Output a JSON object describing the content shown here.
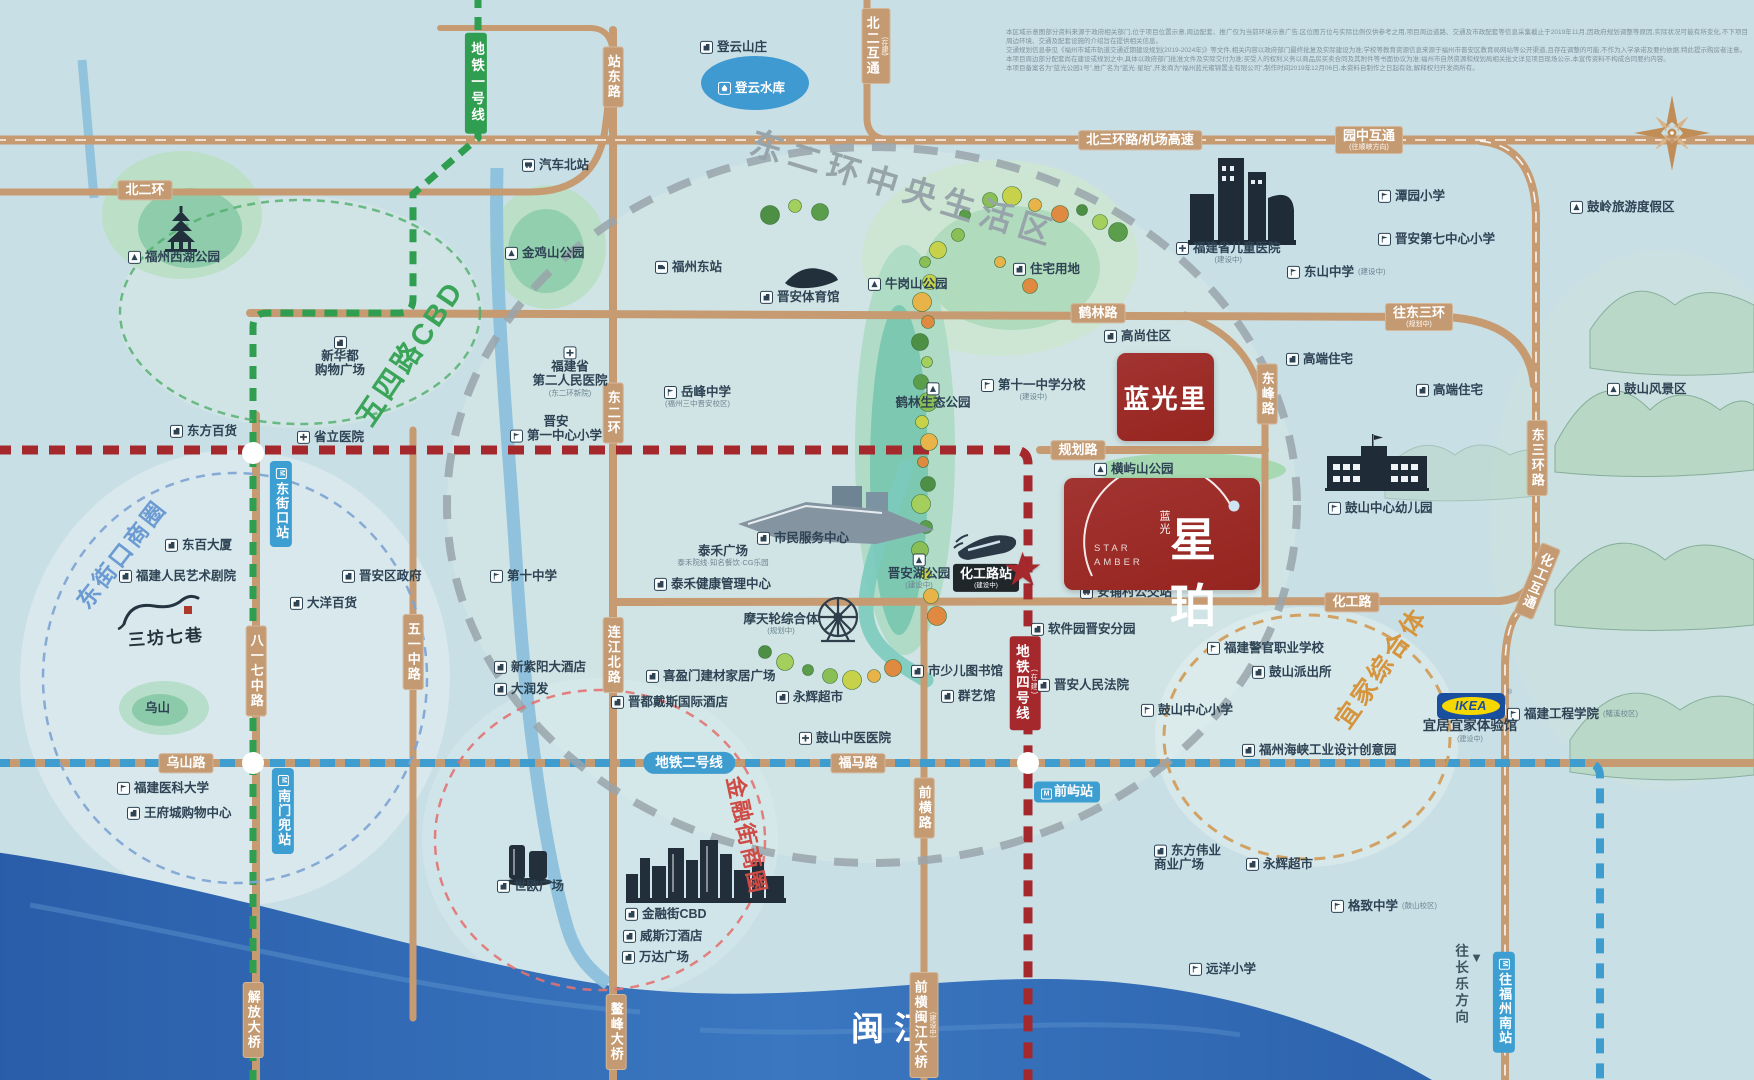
{
  "disclaimer": {
    "lines": [
      "本区域示意图部分资料来源于政府相关部门,位于项目位置示意,周边配套、推广仅为当前环境示意广告,区位图方位与实际比例仅供参考之用,项目周边道路、交通及市政配套等信息采集截止于2019年11月,因政府规划调整等原因,实际状况可能有所变化,不下项目周边环境、交通及配套设施的介绍旨在提供相关信息。",
      "交通规划信息参见《福州市城市轨道交通近期建设规划(2019-2024年)》等文件,相关内容以政府部门最终批复及实际建设为准;学校等教育资源信息来源于福州市晋安区教育局网站等公开渠道,且存在调整的可能,不作为入学承诺及要约依据,特此提示购房者注意。",
      "本项目周边部分配套尚在建设或规划之中,具体以政府部门批准文件及实际交付为准;买受人的权利义务以商品房买卖合同及其附件等书面协议为准;福州市自然资源和规划局相关批文详见项目现场公示,本宣传资料不构成合同要约内容。",
      "本项目备案名为“蓝光公园1号”,推广名为“蓝光·星珀”,开发商为“福州蓝光雍锦置业有限公司”,制作时间2019年12月06日,本资料自制作之日起有效,解释权归开发商所有。"
    ]
  },
  "brand": {
    "cn_small": "蓝光",
    "name": "星珀",
    "en1": "STAR",
    "en2": "AMBER",
    "sister_project": "蓝光里",
    "star": "★"
  },
  "ikea": {
    "logo": "IKEA",
    "reg": "®",
    "label": "宜居宜家体验馆",
    "sub": "(建设中)"
  },
  "water": {
    "minjiang": "闽江"
  },
  "landmarks": {
    "sanfang": "三坊七巷"
  },
  "direction": {
    "changle": "往长乐方向",
    "arrow": "▼"
  },
  "districts": [
    {
      "id": "dongerhuan-living-area",
      "label": "东二环中央生活区",
      "x": 905,
      "y": 186,
      "rot": 17,
      "size": 33,
      "ls": 7,
      "color": "#97a5ab"
    },
    {
      "id": "wusi-road-cbd",
      "label": "五四路CBD",
      "x": 408,
      "y": 352,
      "rot": -56,
      "size": 29,
      "ls": 3,
      "color": "#3aa558"
    },
    {
      "id": "dongjiekou-business-circle",
      "label": "东街口商圈",
      "x": 120,
      "y": 553,
      "rot": -52,
      "size": 23,
      "ls": 3,
      "color": "#6b9bd2"
    },
    {
      "id": "jinrongjie-business-circle",
      "label": "金融街商圈",
      "x": 748,
      "y": 835,
      "rot": 78,
      "size": 22,
      "ls": 2,
      "color": "#cf4b45"
    },
    {
      "id": "yijia-complex",
      "label": "宜家综合体",
      "x": 1380,
      "y": 667,
      "rot": -55,
      "size": 25,
      "ls": 3,
      "color": "#d6953c"
    }
  ],
  "metro_labels": [
    {
      "id": "line-1",
      "label": "地铁一号线",
      "cls": "m-green",
      "x": 476,
      "y": 83
    },
    {
      "id": "line-2",
      "label": "地铁二号线",
      "cls": "m-blue",
      "x": 689,
      "y": 763
    },
    {
      "id": "line-4",
      "label": "地铁四号线",
      "sub": "(在建)",
      "cls": "m-red",
      "x": 1025,
      "y": 683
    }
  ],
  "stations": [
    {
      "id": "dongjiekou",
      "label": "东街口站",
      "cls": "st-blue v",
      "x": 281,
      "y": 504
    },
    {
      "id": "nanmendou",
      "label": "南门兜站",
      "cls": "st-blue v",
      "x": 283,
      "y": 811
    },
    {
      "id": "qianyu",
      "label": "前屿站",
      "cls": "st-blue",
      "x": 1067,
      "y": 792
    },
    {
      "id": "huagonglu-station",
      "label": "化工路站",
      "sub": "(建设中)",
      "cls": "st-black",
      "x": 986,
      "y": 578
    },
    {
      "id": "to-fuzhou-south",
      "label": "往福州南站",
      "cls": "st-blue v",
      "x": 1504,
      "y": 1002
    }
  ],
  "road_labels": [
    {
      "id": "beisanhuan-airport",
      "label": "北三环路/机场高速",
      "x": 1140,
      "y": 140
    },
    {
      "id": "yuanzhong-interchange",
      "label": "园中互通",
      "sub": "(往顺峡方向)",
      "x": 1369,
      "y": 140
    },
    {
      "id": "beierhuan",
      "label": "北二环",
      "x": 145,
      "y": 190
    },
    {
      "id": "beier-interchange",
      "label": "北二互通",
      "sub": "(在建)",
      "v": true,
      "x": 876,
      "y": 46
    },
    {
      "id": "zhandong-road",
      "label": "站东路",
      "v": true,
      "x": 613,
      "y": 77
    },
    {
      "id": "helin-road",
      "label": "鹤林路",
      "x": 1098,
      "y": 313
    },
    {
      "id": "to-dongsanhuan",
      "label": "往东三环",
      "sub": "(规划中)",
      "x": 1419,
      "y": 317
    },
    {
      "id": "dongsanhuan-road",
      "label": "东三环路",
      "v": true,
      "x": 1537,
      "y": 458
    },
    {
      "id": "huagong-interchange",
      "label": "化工互通",
      "v": true,
      "rot": 22,
      "x": 1537,
      "y": 581
    },
    {
      "id": "huagong-road",
      "label": "化工路",
      "x": 1352,
      "y": 602
    },
    {
      "id": "guihua-road",
      "label": "规划路",
      "x": 1078,
      "y": 450
    },
    {
      "id": "dongfeng-road",
      "label": "东峰路",
      "v": true,
      "x": 1267,
      "y": 394
    },
    {
      "id": "dongerhuan-road",
      "label": "东二环",
      "v": true,
      "x": 613,
      "y": 413
    },
    {
      "id": "lianjiangbei-road",
      "label": "连江北路",
      "v": true,
      "x": 613,
      "y": 655
    },
    {
      "id": "wuyizhong-road",
      "label": "五一中路",
      "v": true,
      "x": 413,
      "y": 652
    },
    {
      "id": "bayiqizhong-road",
      "label": "八一七中路",
      "v": true,
      "x": 256,
      "y": 671
    },
    {
      "id": "wushan-road",
      "label": "乌山路",
      "x": 186,
      "y": 763
    },
    {
      "id": "fuma-road",
      "label": "福马路",
      "x": 858,
      "y": 763
    },
    {
      "id": "qianheng-road",
      "label": "前横路",
      "v": true,
      "x": 924,
      "y": 808
    },
    {
      "id": "jiefang-bridge",
      "label": "解放大桥",
      "v": true,
      "x": 253,
      "y": 1020
    },
    {
      "id": "aofeng-bridge",
      "label": "鳌峰大桥",
      "v": true,
      "x": 616,
      "y": 1032
    },
    {
      "id": "qianheng-minjiang-bridge",
      "label": "前横闽江大桥",
      "sub": "(建设中)",
      "v": true,
      "x": 924,
      "y": 1025
    }
  ],
  "pois": [
    {
      "id": "dengyun-villa",
      "icon": "building",
      "label": "登云山庄",
      "x": 700,
      "y": 47
    },
    {
      "id": "dengyun-reservoir",
      "icon": "water",
      "label": "登云水库",
      "x": 718,
      "y": 88,
      "white": true
    },
    {
      "id": "qiche-beizhan",
      "icon": "bus",
      "label": "汽车北站",
      "x": 522,
      "y": 165
    },
    {
      "id": "fuzhou-east-station",
      "icon": "train",
      "label": "福州东站",
      "x": 655,
      "y": 267
    },
    {
      "id": "jinjishan-park",
      "icon": "mountain",
      "label": "金鸡山公园",
      "x": 505,
      "y": 253
    },
    {
      "id": "xihu-park",
      "icon": "mountain",
      "label": "福州西湖公园",
      "x": 128,
      "y": 257
    },
    {
      "id": "jinan-stadium",
      "icon": "building",
      "label": "晋安体育馆",
      "x": 760,
      "y": 297
    },
    {
      "id": "niugangshan-park",
      "icon": "mountain",
      "label": "牛岗山公园",
      "x": 868,
      "y": 284
    },
    {
      "id": "zhuzhai-land",
      "icon": "building",
      "label": "住宅用地",
      "x": 1013,
      "y": 269
    },
    {
      "id": "children-hospital",
      "icon": "hospital",
      "label": "福建省儿童医院",
      "sub": "(建设中)",
      "subpos": "below",
      "x": 1176,
      "y": 253
    },
    {
      "id": "tanyuan-primary",
      "icon": "school",
      "label": "潭园小学",
      "x": 1378,
      "y": 196
    },
    {
      "id": "jinan-no7-primary",
      "icon": "school",
      "label": "晋安第七中心小学",
      "x": 1378,
      "y": 239
    },
    {
      "id": "dongshan-middle",
      "icon": "school",
      "label": "东山中学",
      "sub": "(建设中)",
      "x": 1287,
      "y": 272
    },
    {
      "id": "gaoshang-zhuqu",
      "icon": "building",
      "label": "高尚住区",
      "x": 1104,
      "y": 336
    },
    {
      "id": "gaoduan-zhuzhai-1",
      "icon": "building",
      "label": "高端住宅",
      "x": 1286,
      "y": 359
    },
    {
      "id": "gaoduan-zhuzhai-2",
      "icon": "building",
      "label": "高端住宅",
      "x": 1416,
      "y": 390
    },
    {
      "id": "no11-middle-branch",
      "icon": "school",
      "label": "第十一中学分校",
      "sub": "(建设中)",
      "subpos": "below",
      "x": 981,
      "y": 390
    },
    {
      "id": "hengyushan-park",
      "icon": "mountain",
      "label": "横屿山公园",
      "x": 1094,
      "y": 469
    },
    {
      "id": "guling-resort",
      "icon": "mountain",
      "label": "鼓岭旅游度假区",
      "x": 1570,
      "y": 207
    },
    {
      "id": "gushan-scenic",
      "icon": "mountain",
      "label": "鼓山风景区",
      "x": 1607,
      "y": 389
    },
    {
      "id": "gushan-kindergarten",
      "icon": "school",
      "label": "鼓山中心幼儿园",
      "x": 1328,
      "y": 508
    },
    {
      "id": "helin-eco-park",
      "icon": "mountain",
      "label": "鹤林生态公园",
      "x": 933,
      "y": 396,
      "center": true,
      "icontop": true
    },
    {
      "id": "yuefeng-middle",
      "icon": "school",
      "label": "岳峰中学",
      "sub": "(福州三中晋安校区)",
      "subpos": "below",
      "x": 664,
      "y": 397
    },
    {
      "id": "prov-2nd-hospital",
      "icon": "hospital",
      "lines": [
        "福建省",
        "第二人民医院"
      ],
      "sub": "(东二环新院)",
      "subpos": "below",
      "center": true,
      "icontop": true,
      "x": 570,
      "y": 372
    },
    {
      "id": "jinan-no1-primary",
      "icon": "school",
      "lines": [
        "晋安",
        "第一中心小学"
      ],
      "iconline": 1,
      "center": true,
      "x": 556,
      "y": 429
    },
    {
      "id": "xinhuadu-mall",
      "icon": "building",
      "lines": [
        "新华都",
        "购物广场"
      ],
      "center": true,
      "icontop": true,
      "x": 340,
      "y": 357
    },
    {
      "id": "no10-middle",
      "icon": "school",
      "label": "第十中学",
      "x": 490,
      "y": 576
    },
    {
      "id": "jinan-district-govt",
      "icon": "building",
      "label": "晋安区政府",
      "x": 342,
      "y": 576
    },
    {
      "id": "dongfang-dept-store",
      "icon": "building",
      "label": "东方百货",
      "x": 170,
      "y": 431
    },
    {
      "id": "provincial-hospital",
      "icon": "hospital",
      "label": "省立医院",
      "x": 297,
      "y": 437
    },
    {
      "id": "dongbai-building",
      "icon": "building",
      "label": "东百大厦",
      "x": 165,
      "y": 545
    },
    {
      "id": "renmin-art-theatre",
      "icon": "building",
      "label": "福建人民艺术剧院",
      "x": 119,
      "y": 576
    },
    {
      "id": "dayang-dept-store",
      "icon": "building",
      "label": "大洋百货",
      "x": 290,
      "y": 603
    },
    {
      "id": "wushan-hill",
      "label": "乌山",
      "noicon": true,
      "x": 145,
      "y": 708
    },
    {
      "id": "fujian-medical-univ",
      "icon": "school",
      "label": "福建医科大学",
      "x": 117,
      "y": 788
    },
    {
      "id": "wangfucheng-mall",
      "icon": "building",
      "label": "王府城购物中心",
      "x": 127,
      "y": 813
    },
    {
      "id": "xinziyang-hotel",
      "icon": "building",
      "label": "新紫阳大酒店",
      "x": 494,
      "y": 667
    },
    {
      "id": "darunfa",
      "icon": "building",
      "label": "大润发",
      "x": 494,
      "y": 689
    },
    {
      "id": "xiyingmen-plaza",
      "icon": "building",
      "label": "喜盈门建材家居广场",
      "x": 646,
      "y": 676
    },
    {
      "id": "jindu-days-hotel",
      "icon": "building",
      "label": "晋都戴斯国际酒店",
      "x": 611,
      "y": 702
    },
    {
      "id": "yonghui-market-1",
      "icon": "building",
      "label": "永辉超市",
      "x": 776,
      "y": 697
    },
    {
      "id": "gushan-tcm-hospital",
      "icon": "hospital",
      "label": "鼓山中医医院",
      "x": 799,
      "y": 738
    },
    {
      "id": "citizen-service-center",
      "icon": "building",
      "label": "市民服务中心",
      "x": 757,
      "y": 538
    },
    {
      "id": "taihe-plaza",
      "label": "泰禾广场",
      "sub": "泰禾院线·知名餐饮·CG乐园",
      "subpos": "below",
      "center": true,
      "noicon": true,
      "x": 723,
      "y": 556
    },
    {
      "id": "taihe-health-center",
      "icon": "building",
      "label": "泰禾健康管理中心",
      "x": 654,
      "y": 584
    },
    {
      "id": "ferris-wheel-complex",
      "label": "摩天轮综合体",
      "sub": "(规划中)",
      "subpos": "below",
      "center": true,
      "noicon": true,
      "x": 781,
      "y": 624
    },
    {
      "id": "jinanhu-park",
      "icon": "mountain",
      "label": "晋安湖公园",
      "sub": "(建设中)",
      "subpos": "below",
      "center": true,
      "icontop": true,
      "x": 919,
      "y": 572
    },
    {
      "id": "children-library",
      "icon": "building",
      "label": "市少儿图书馆",
      "x": 911,
      "y": 671
    },
    {
      "id": "qunyi-hall",
      "icon": "building",
      "label": "群艺馆",
      "x": 941,
      "y": 696
    },
    {
      "id": "jinan-court",
      "icon": "building",
      "label": "晋安人民法院",
      "x": 1037,
      "y": 685
    },
    {
      "id": "software-park-jinan",
      "icon": "building",
      "label": "软件园晋安分园",
      "x": 1031,
      "y": 629
    },
    {
      "id": "anpucun-bus-stop",
      "icon": "bus",
      "label": "安铺村公交站",
      "x": 1080,
      "y": 592
    },
    {
      "id": "police-vocational-school",
      "icon": "school",
      "label": "福建警官职业学校",
      "x": 1207,
      "y": 648
    },
    {
      "id": "gushan-police-station",
      "icon": "building",
      "label": "鼓山派出所",
      "x": 1252,
      "y": 672
    },
    {
      "id": "gushan-central-primary",
      "icon": "school",
      "label": "鼓山中心小学",
      "x": 1141,
      "y": 710
    },
    {
      "id": "haixia-design-park",
      "icon": "building",
      "label": "福州海峡工业设计创意园",
      "x": 1242,
      "y": 750
    },
    {
      "id": "fujian-univ-of-tech",
      "icon": "school",
      "label": "福建工程学院",
      "sub": "(鳝溪校区)",
      "x": 1507,
      "y": 714
    },
    {
      "id": "dongfang-weiye",
      "icon": "building",
      "lines": [
        "东方伟业",
        "商业广场"
      ],
      "iconline": 0,
      "x": 1154,
      "y": 858
    },
    {
      "id": "yonghui-market-2",
      "icon": "building",
      "label": "永辉超市",
      "x": 1246,
      "y": 864
    },
    {
      "id": "gezhi-middle",
      "icon": "school",
      "label": "格致中学",
      "sub": "(鼓山校区)",
      "x": 1331,
      "y": 906
    },
    {
      "id": "yuanyang-primary",
      "icon": "school",
      "label": "远洋小学",
      "x": 1189,
      "y": 969
    },
    {
      "id": "jinrongjie-cbd",
      "icon": "building",
      "label": "金融街CBD",
      "x": 625,
      "y": 914
    },
    {
      "id": "westin-hotel",
      "icon": "building",
      "label": "威斯汀酒店",
      "x": 623,
      "y": 936
    },
    {
      "id": "wanda-plaza",
      "icon": "building",
      "label": "万达广场",
      "x": 622,
      "y": 957
    },
    {
      "id": "shiou-plaza",
      "icon": "building",
      "label": "世欧广场",
      "x": 497,
      "y": 886
    }
  ]
}
